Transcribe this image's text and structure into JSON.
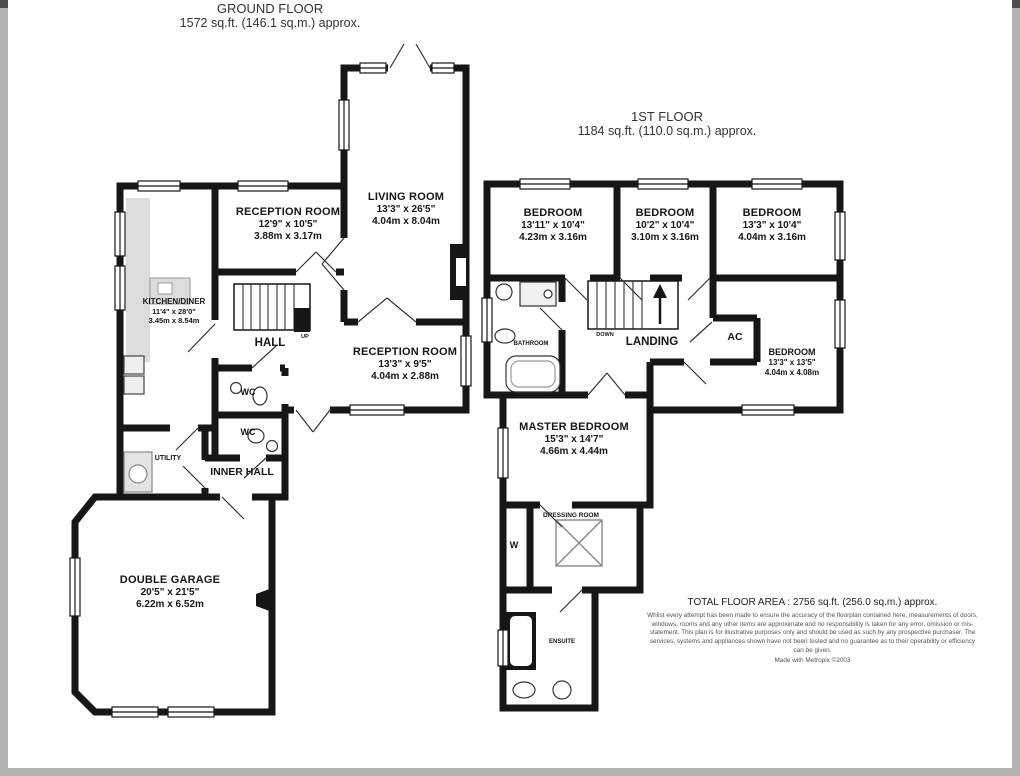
{
  "colors": {
    "wall": "#161616",
    "fixture_gray": "#dcdcdc",
    "frame_gray": "#b3b3b3"
  },
  "ground_floor": {
    "title": "GROUND FLOOR",
    "area": "1572 sq.ft. (146.1 sq.m.) approx.",
    "rooms": {
      "living_room": {
        "name": "LIVING ROOM",
        "imperial": "13'3\" x 26'5\"",
        "metric": "4.04m x 8.04m"
      },
      "reception_room_1": {
        "name": "RECEPTION ROOM",
        "imperial": "12'9\" x 10'5\"",
        "metric": "3.88m x 3.17m"
      },
      "kitchen_diner": {
        "name": "KITCHEN/DINER",
        "imperial": "11'4\" x 28'0\"",
        "metric": "3.45m x 8.54m"
      },
      "hall": {
        "name": "HALL"
      },
      "stairs_up": {
        "name": "UP"
      },
      "reception_room_2": {
        "name": "RECEPTION ROOM",
        "imperial": "13'3\" x 9'5\"",
        "metric": "4.04m x 2.88m"
      },
      "wc_1": {
        "name": "WC"
      },
      "wc_2": {
        "name": "WC"
      },
      "utility": {
        "name": "UTILITY"
      },
      "inner_hall": {
        "name": "INNER HALL"
      },
      "double_garage": {
        "name": "DOUBLE GARAGE",
        "imperial": "20'5\" x 21'5\"",
        "metric": "6.22m x 6.52m"
      }
    }
  },
  "first_floor": {
    "title": "1ST FLOOR",
    "area": "1184 sq.ft. (110.0 sq.m.) approx.",
    "rooms": {
      "bedroom_1": {
        "name": "BEDROOM",
        "imperial": "13'11\" x 10'4\"",
        "metric": "4.23m x 3.16m"
      },
      "bedroom_2": {
        "name": "BEDROOM",
        "imperial": "10'2\" x 10'4\"",
        "metric": "3.10m x 3.16m"
      },
      "bedroom_3": {
        "name": "BEDROOM",
        "imperial": "13'3\" x 10'4\"",
        "metric": "4.04m x 3.16m"
      },
      "bathroom": {
        "name": "BATHROOM"
      },
      "landing": {
        "name": "LANDING"
      },
      "stairs_down": {
        "name": "DOWN"
      },
      "ac": {
        "name": "AC"
      },
      "bedroom_4": {
        "name": "BEDROOM",
        "imperial": "13'3\" x 13'5\"",
        "metric": "4.04m x 4.08m"
      },
      "master_bedroom": {
        "name": "MASTER BEDROOM",
        "imperial": "15'3\" x 14'7\"",
        "metric": "4.66m x 4.44m"
      },
      "dressing_room": {
        "name": "DRESSING ROOM"
      },
      "wardrobe": {
        "name": "W"
      },
      "ensuite": {
        "name": "ENSUITE"
      }
    }
  },
  "footer": {
    "total_area": "TOTAL FLOOR AREA : 2756 sq.ft. (256.0 sq.m.) approx.",
    "disclaimer": "Whilst every attempt has been made to ensure the accuracy of the floorplan contained here, measurements of doors, windows, rooms and any other items are approximate and no responsibility is taken for any error, omission or mis-statement. This plan is for illustrative purposes only and should be used as such by any prospective purchaser. The services, systems and appliances shown have not been tested and no guarantee as to their operability or efficiency can be given.",
    "credit": "Made with Metropix ©2003"
  }
}
